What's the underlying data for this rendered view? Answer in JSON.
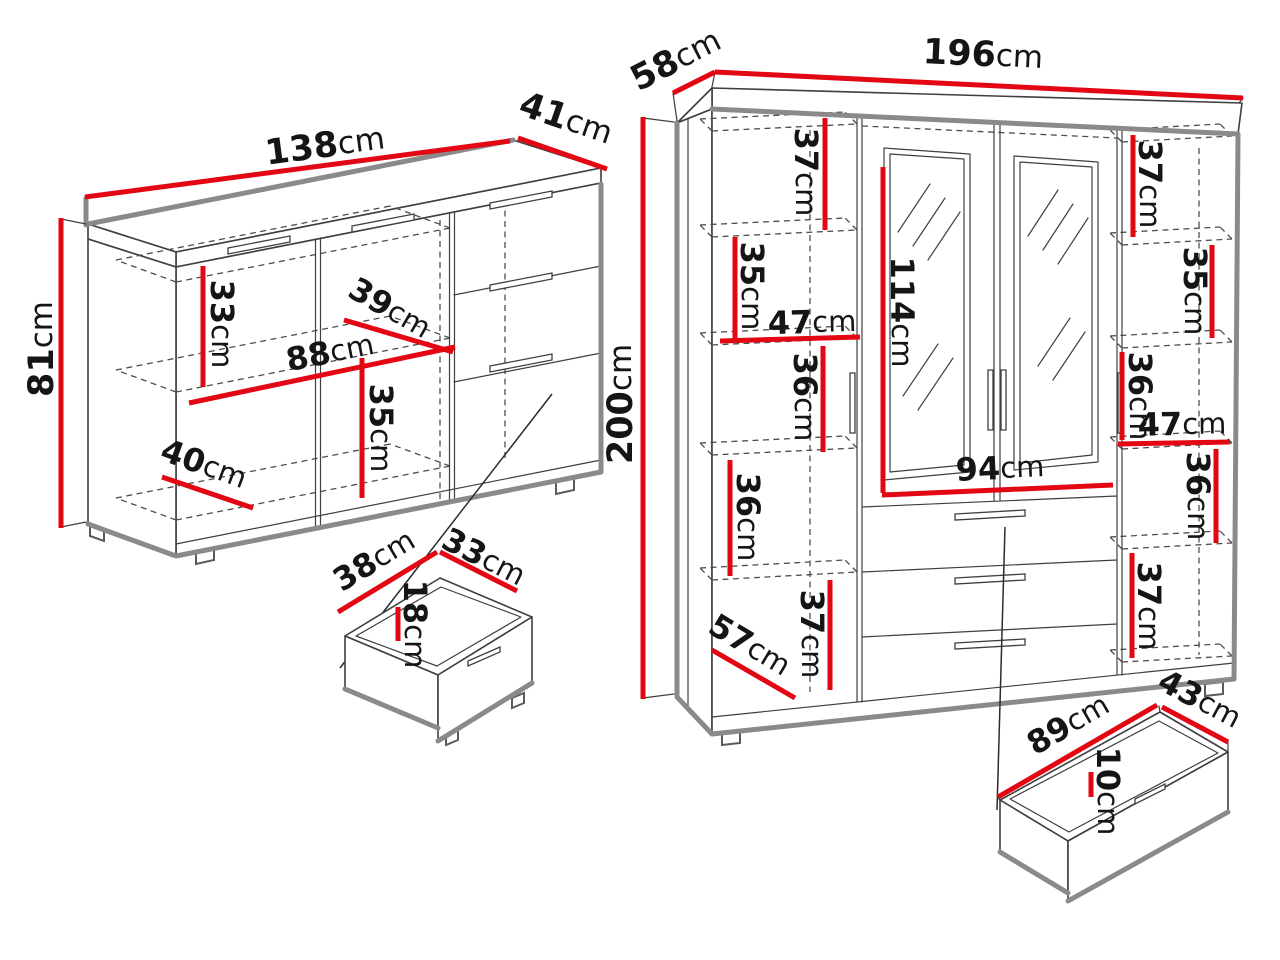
{
  "colors": {
    "dimension_red": "#e30613",
    "outline_dark": "#3f3f3f",
    "edge_gray": "#8a8a8a",
    "text": "#151515",
    "background": "#ffffff"
  },
  "sideboard": {
    "width": {
      "value": "138",
      "unit": "cm"
    },
    "depth": {
      "value": "41",
      "unit": "cm"
    },
    "height": {
      "value": "81",
      "unit": "cm"
    },
    "interior": {
      "top_shelf_gap": {
        "value": "33",
        "unit": "cm"
      },
      "shelf_depth": {
        "value": "39",
        "unit": "cm"
      },
      "inner_width": {
        "value": "88",
        "unit": "cm"
      },
      "middle_shelf_gap": {
        "value": "35",
        "unit": "cm"
      },
      "inner_depth": {
        "value": "40",
        "unit": "cm"
      }
    },
    "drawer": {
      "width": {
        "value": "38",
        "unit": "cm"
      },
      "depth": {
        "value": "33",
        "unit": "cm"
      },
      "height": {
        "value": "18",
        "unit": "cm"
      }
    }
  },
  "wardrobe": {
    "width": {
      "value": "196",
      "unit": "cm"
    },
    "depth": {
      "value": "58",
      "unit": "cm"
    },
    "height": {
      "value": "200",
      "unit": "cm"
    },
    "left_column": {
      "gap_1": {
        "value": "37",
        "unit": "cm"
      },
      "gap_2": {
        "value": "35",
        "unit": "cm"
      },
      "inner_width": {
        "value": "47",
        "unit": "cm"
      },
      "gap_3": {
        "value": "36",
        "unit": "cm"
      },
      "gap_4": {
        "value": "36",
        "unit": "cm"
      },
      "gap_5": {
        "value": "37",
        "unit": "cm"
      },
      "inner_depth": {
        "value": "57",
        "unit": "cm"
      }
    },
    "center": {
      "mirror_door_height": {
        "value": "114",
        "unit": "cm"
      },
      "inner_width": {
        "value": "94",
        "unit": "cm"
      }
    },
    "right_column": {
      "gap_1": {
        "value": "37",
        "unit": "cm"
      },
      "gap_2": {
        "value": "35",
        "unit": "cm"
      },
      "gap_3": {
        "value": "36",
        "unit": "cm"
      },
      "inner_width": {
        "value": "47",
        "unit": "cm"
      },
      "gap_4": {
        "value": "36",
        "unit": "cm"
      },
      "gap_5": {
        "value": "37",
        "unit": "cm"
      }
    },
    "drawer": {
      "width": {
        "value": "89",
        "unit": "cm"
      },
      "depth": {
        "value": "43",
        "unit": "cm"
      },
      "height": {
        "value": "10",
        "unit": "cm"
      }
    }
  }
}
